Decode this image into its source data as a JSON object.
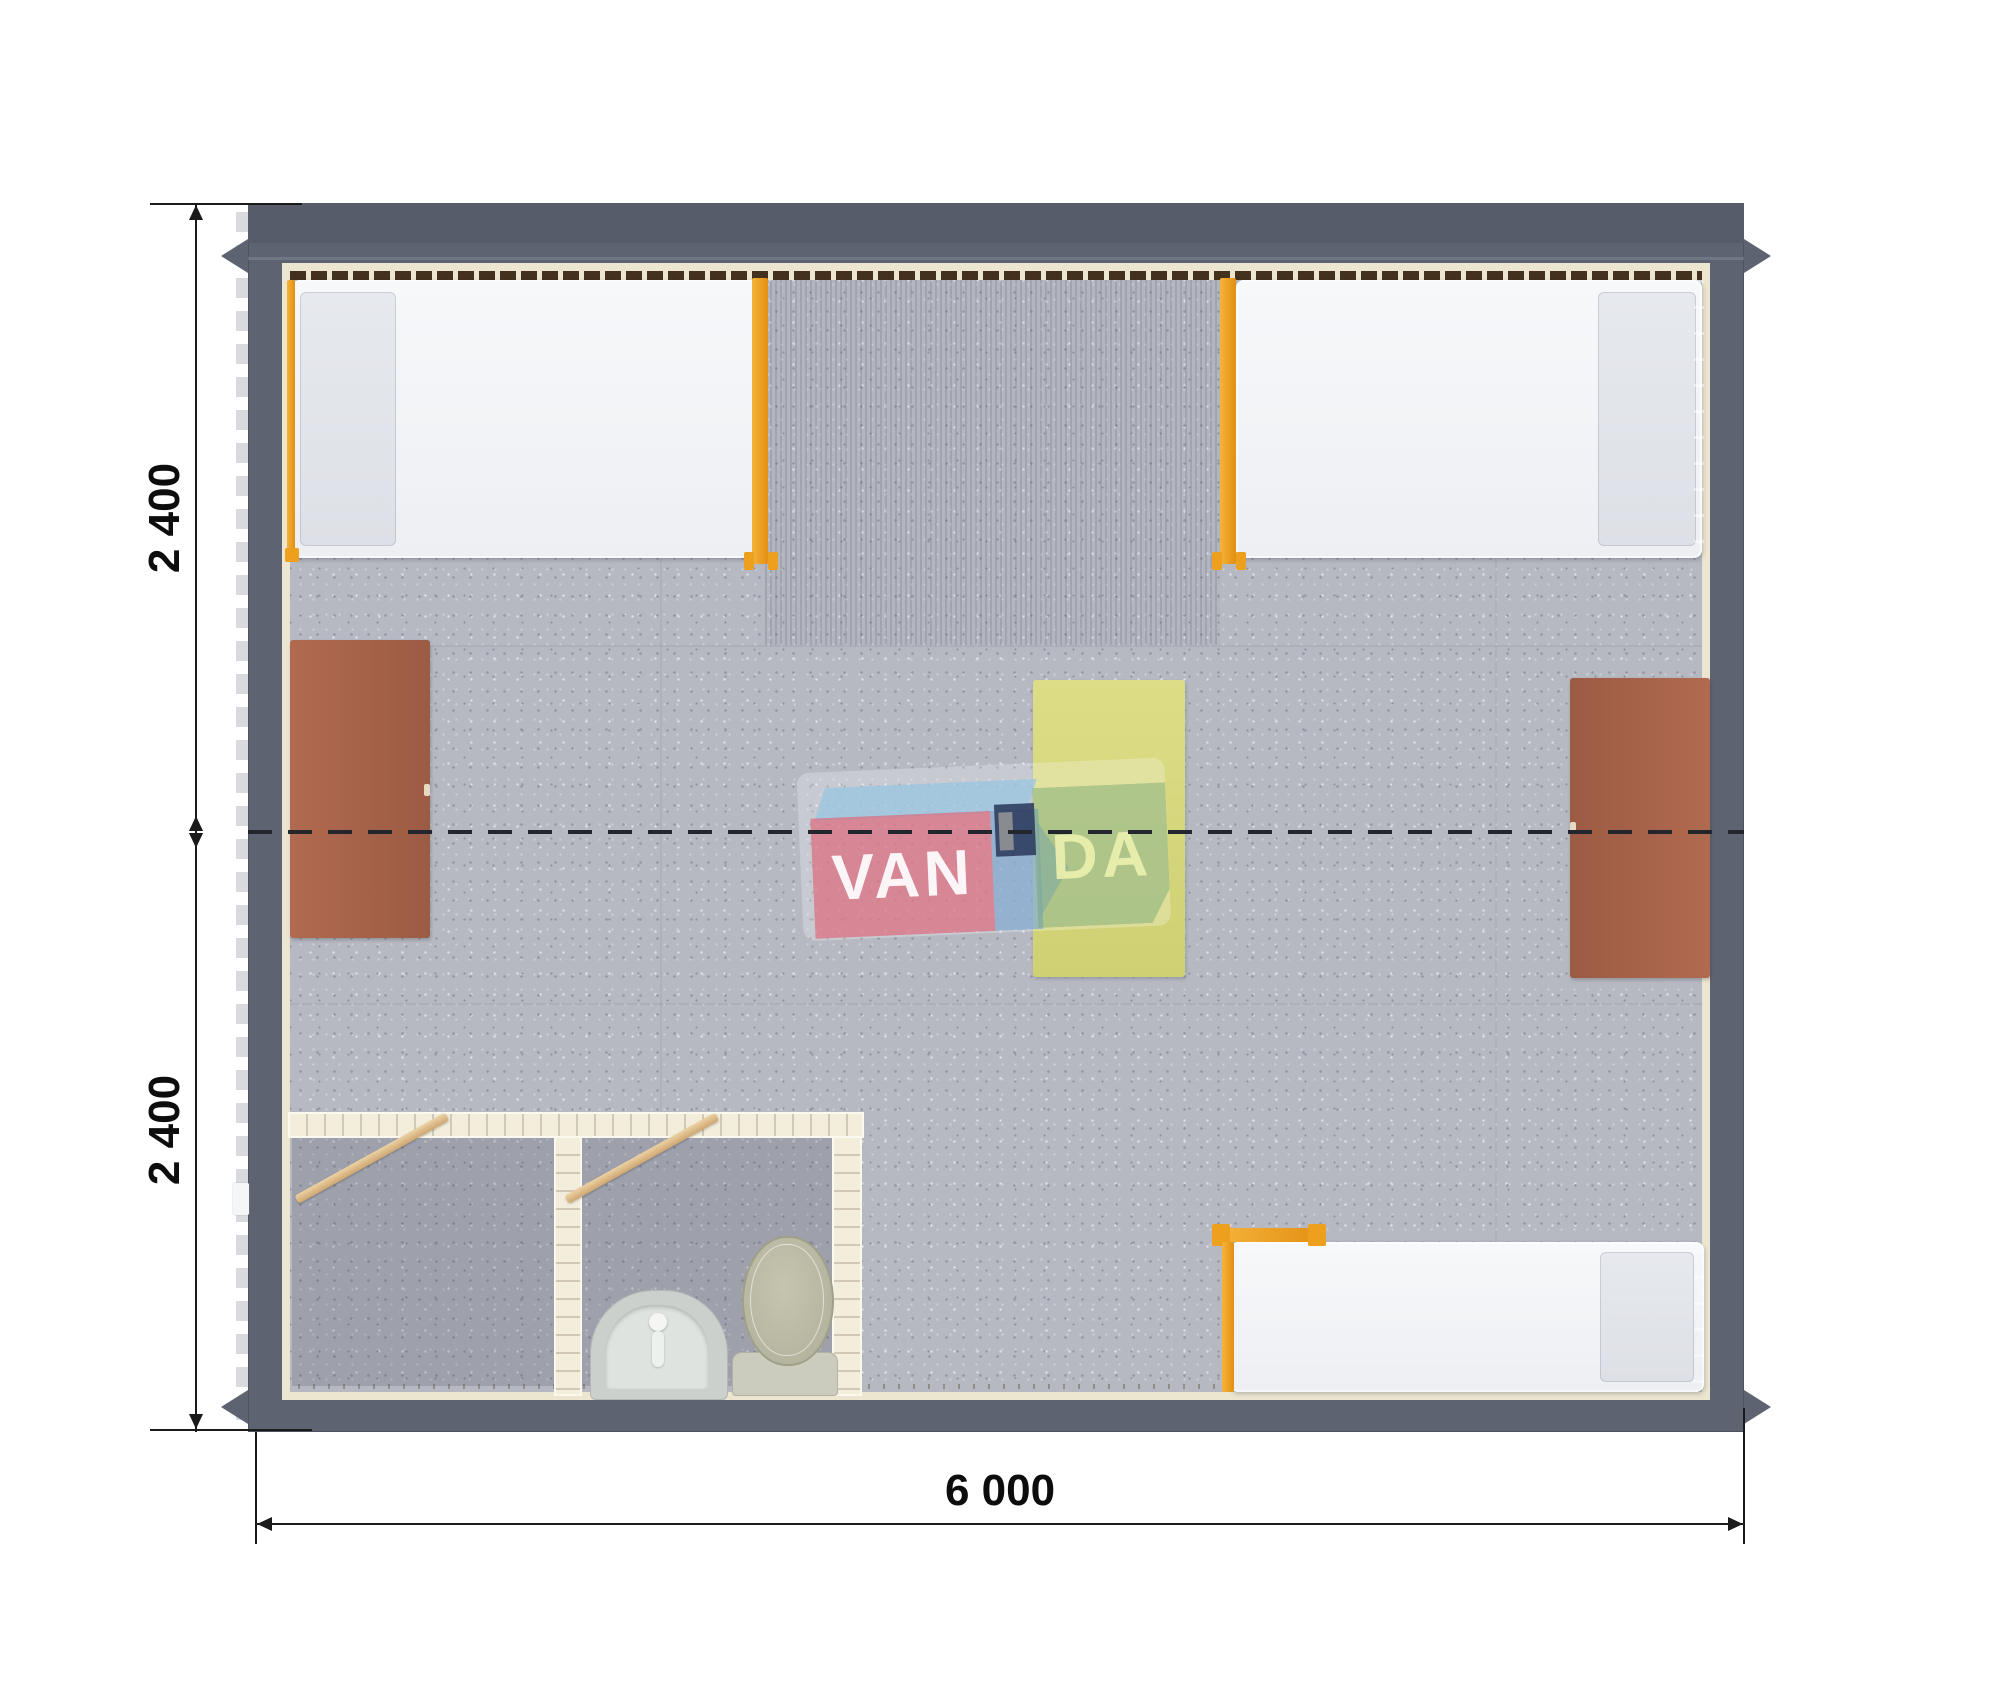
{
  "dimensions": {
    "left_top": "2 400",
    "left_bottom": "2 400",
    "bottom": "6 000"
  },
  "watermark": {
    "full": "VANDA",
    "part_van": "VAN",
    "part_da": "DA"
  },
  "colors": {
    "wall": "#5d6370",
    "wall_dark": "#565c69",
    "floor": "#b6b8c2",
    "lining_cream": "#ece5d0",
    "window_band": "#43301d",
    "bed_frame_orange": "#f0a125",
    "mattress_white": "#f3f5f8",
    "pillow_gray": "#e2e5ea",
    "desk_brown": "#a8644b",
    "table_yellow": "#d6d77e",
    "door_leaf_tan": "#dec293",
    "bath_wall": "#f3eddc",
    "sink_gray": "#ccd0cc",
    "toilet_green_gray": "#b8b8a2",
    "dimension_text": "#0d0d0d",
    "watermark_pink": "#db6a7c",
    "watermark_blue": "#9ac6e2",
    "watermark_navy": "#2b3a5c",
    "watermark_green": "#7aa876"
  },
  "furniture": {
    "beds": [
      "bed-top-left",
      "bed-top-right",
      "bed-bottom-right"
    ],
    "desks": [
      "desk-left",
      "desk-right"
    ],
    "table": "table-center",
    "bathroom_fixtures": [
      "sink",
      "toilet"
    ],
    "doors": [
      "door-leaf-left",
      "door-leaf-right"
    ]
  }
}
